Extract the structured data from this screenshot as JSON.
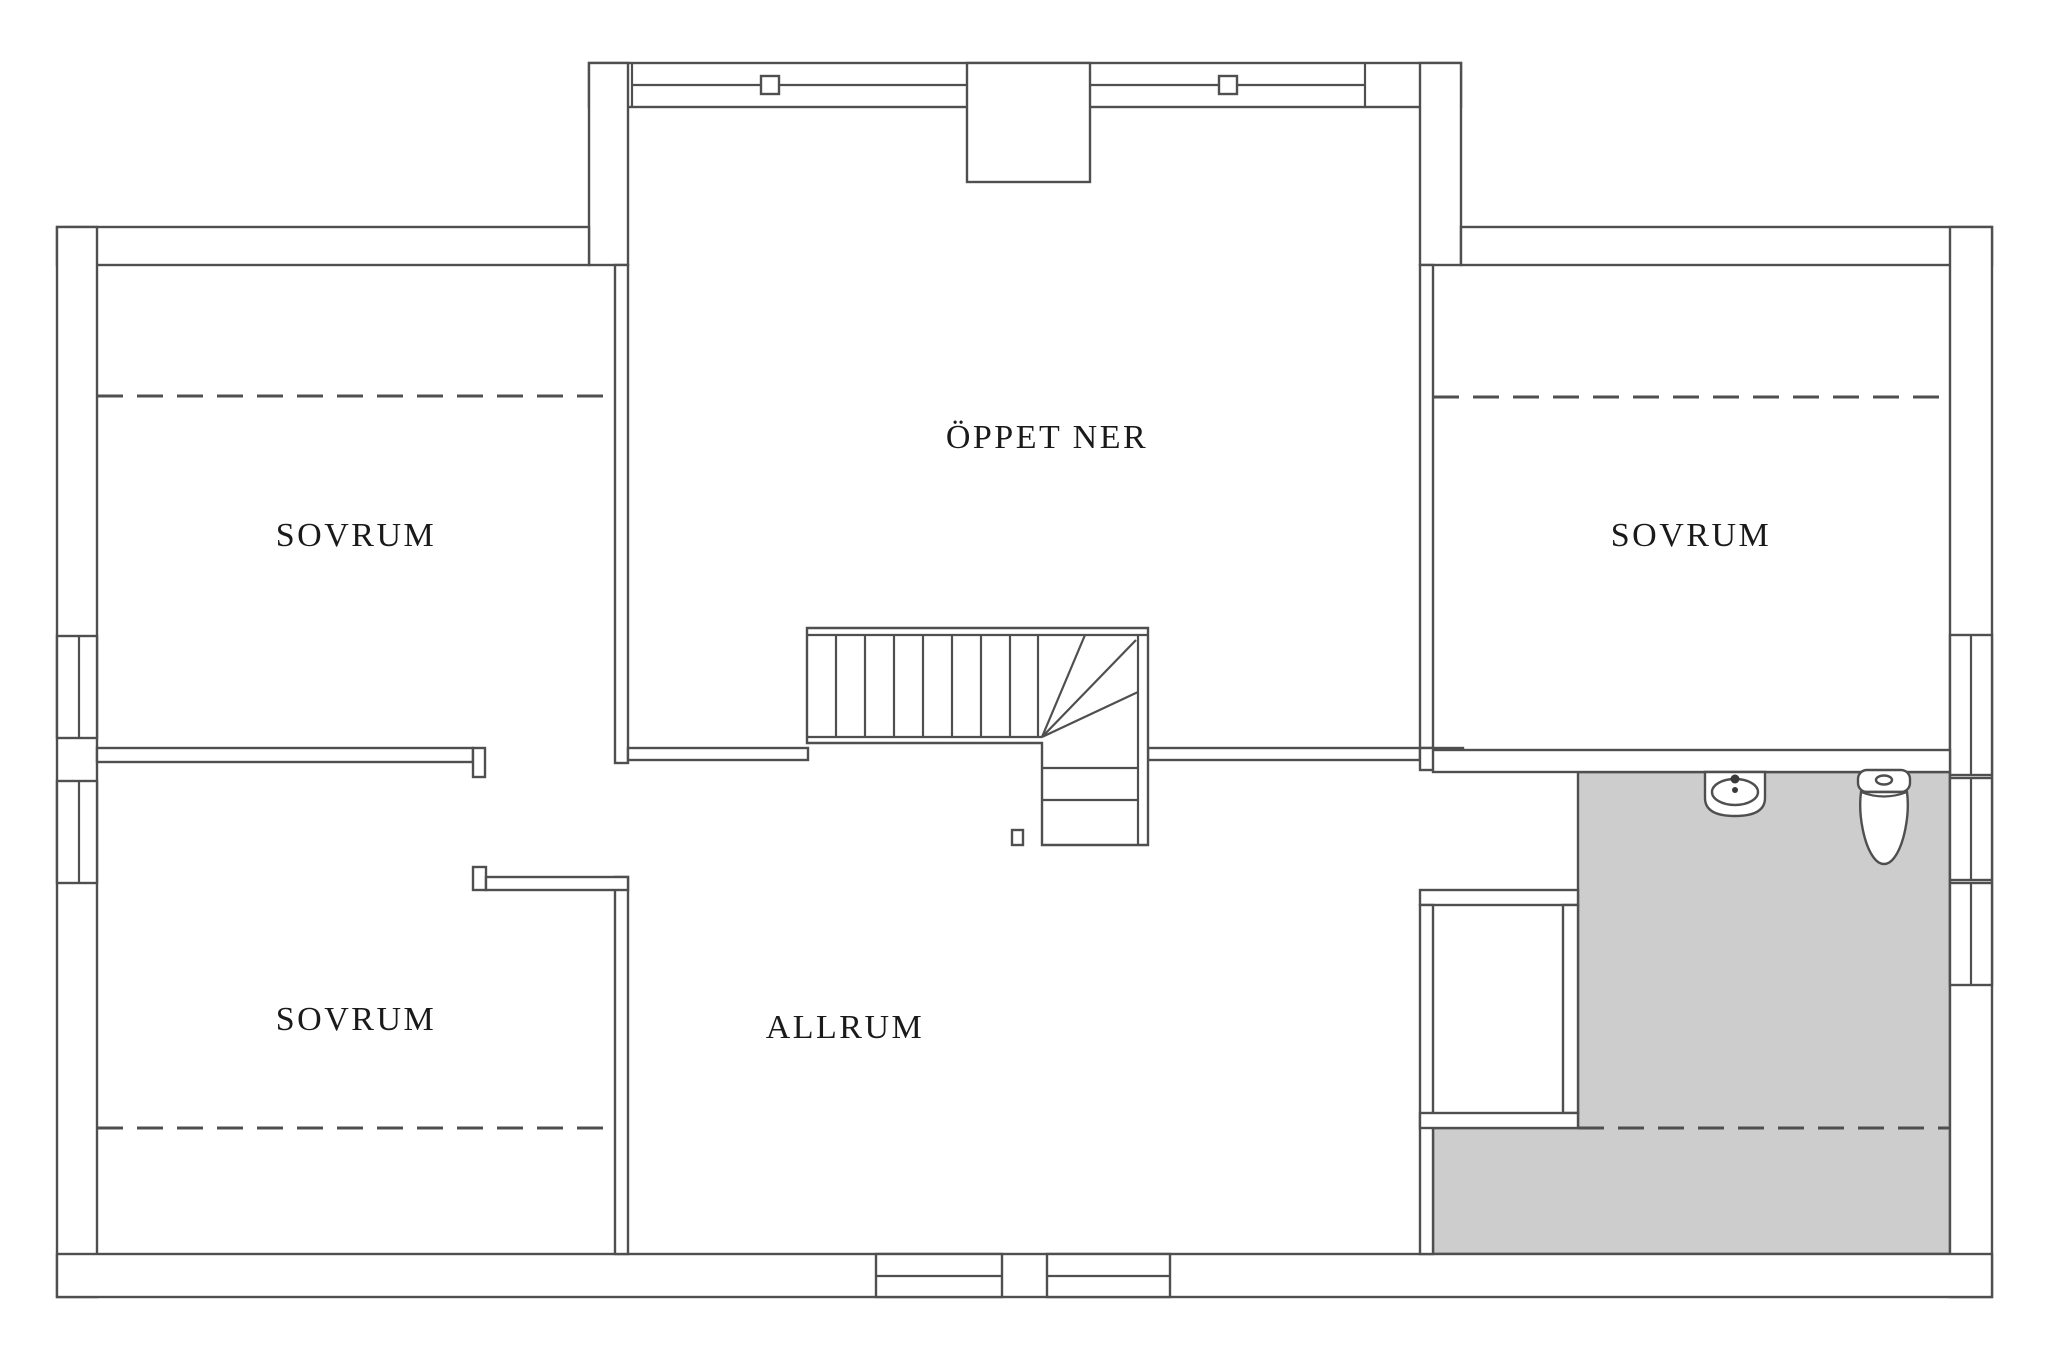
{
  "floorplan": {
    "rooms": [
      {
        "id": "sovrum-top-left",
        "label": "SOVRUM"
      },
      {
        "id": "sovrum-top-right",
        "label": "SOVRUM"
      },
      {
        "id": "sovrum-bottom-left",
        "label": "SOVRUM"
      },
      {
        "id": "allrum",
        "label": "ALLRUM"
      },
      {
        "id": "oppet-ner",
        "label": "ÖPPET NER"
      }
    ],
    "colors": {
      "line": "#4f4f4f",
      "bathroom_fill": "#cdcdcd",
      "background": "#ffffff",
      "label_text": "#1a1a1a"
    }
  }
}
